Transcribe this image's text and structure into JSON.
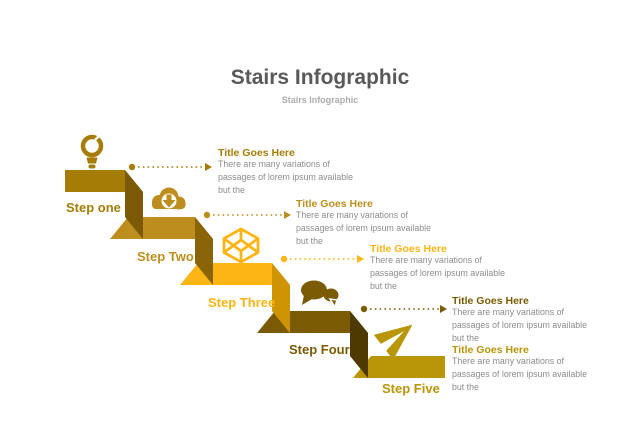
{
  "header": {
    "title": "Stairs Infographic",
    "subtitle": "Stairs Infographic"
  },
  "colors": {
    "title_text": "#595959",
    "subtitle_text": "#acacac",
    "body_text": "#8c8c8c",
    "background": "#ffffff"
  },
  "steps": [
    {
      "label": "Step one",
      "icon": "lightbulb-icon",
      "color": "#a57c06",
      "shade": "#7c5a05",
      "callout": {
        "title": "Title Goes Here",
        "lines": [
          "There are many variations of",
          "passages of lorem ipsum available",
          "but the"
        ]
      }
    },
    {
      "label": "Step Two",
      "icon": "cloud-download-icon",
      "color": "#bd8e1e",
      "shade": "#8a6508",
      "callout": {
        "title": "Title Goes Here",
        "lines": [
          "There are many variations of",
          "passages of lorem ipsum available",
          "but the"
        ]
      }
    },
    {
      "label": "Step Three",
      "icon": "cube-icon",
      "color": "#fdb515",
      "shade": "#ce9404",
      "callout": {
        "title": "Title Goes Here",
        "lines": [
          "There are many variations of",
          "passages of lorem ipsum available",
          "but the"
        ]
      }
    },
    {
      "label": "Step Four",
      "icon": "chat-bubbles-icon",
      "color": "#7a5b04",
      "shade": "#4e3a01",
      "callout": {
        "title": "Title Goes Here",
        "lines": [
          "There are many variations of",
          "passages of lorem ipsum available",
          "but the"
        ]
      }
    },
    {
      "label": "Step Five",
      "icon": "paper-plane-icon",
      "color": "#b99508",
      "shade": "#8a6e06",
      "callout": {
        "title": "Title Goes Here",
        "lines": [
          "There are many variations of",
          "passages of lorem ipsum available",
          "but the"
        ]
      }
    }
  ]
}
